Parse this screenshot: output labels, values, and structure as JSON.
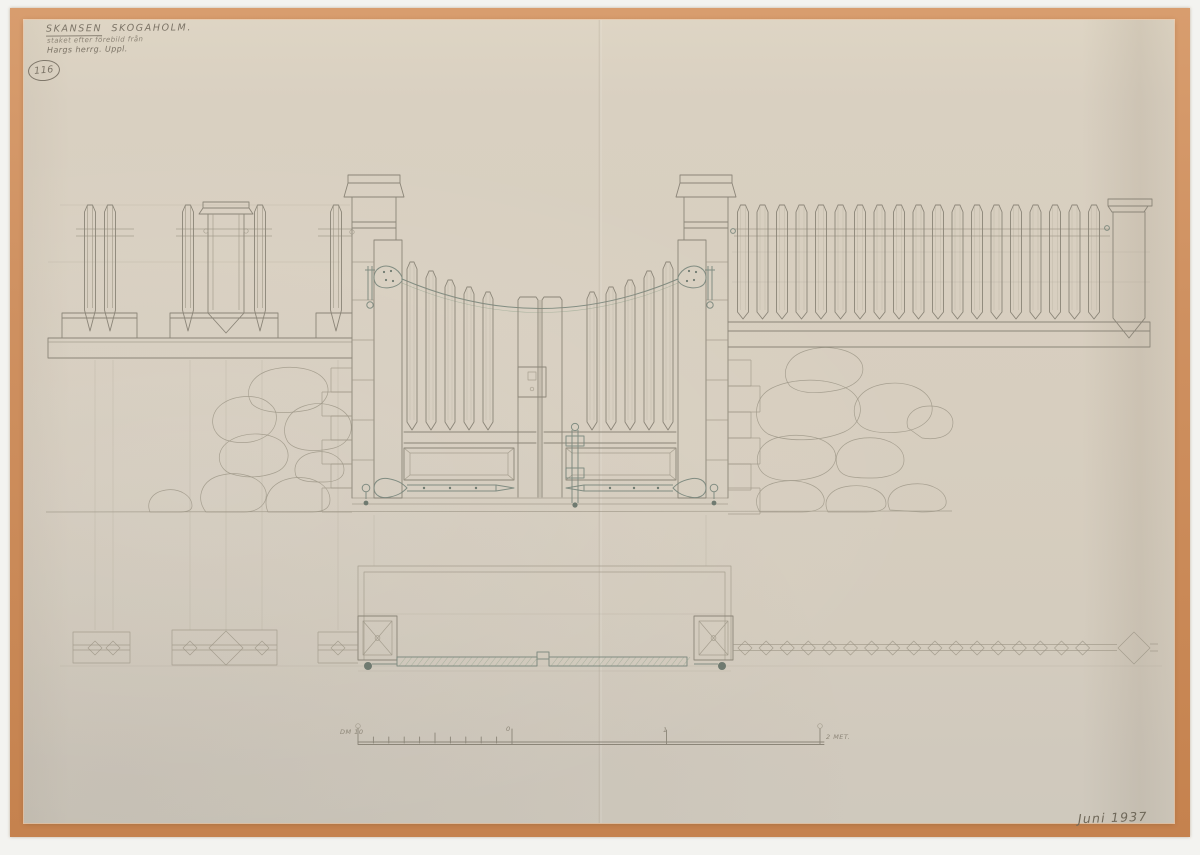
{
  "annotations": {
    "title_word1": "SKANSEN",
    "title_word2": "SKOGAHOLM.",
    "subtitle_line1": "staket efter förebild från",
    "subtitle_line2": "Hargs herrg. Uppl.",
    "drawing_number": "116",
    "date": "Juni 1937"
  },
  "scale_bar": {
    "left_label": "DM 10",
    "zero_label": "0",
    "meter_one_label": "1",
    "right_label": "2 MET."
  },
  "colors": {
    "mount_frame": "#cf9161",
    "paper": "#d7cebf",
    "pencil": "#8b8578",
    "hardware_ink": "#78857b"
  }
}
